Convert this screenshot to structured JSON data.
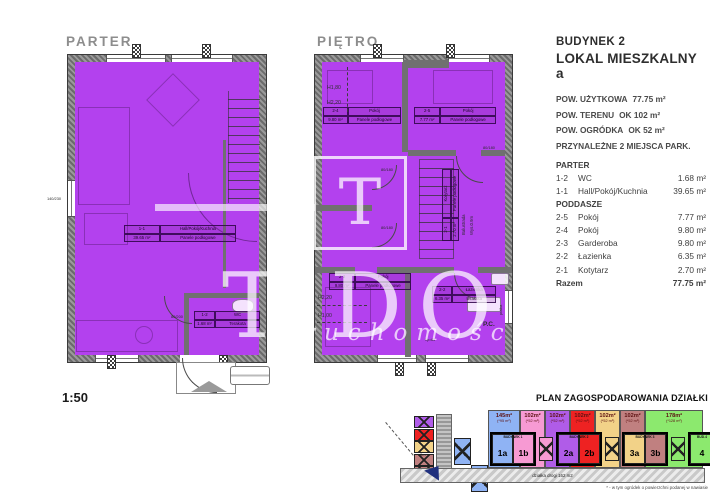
{
  "scale_label": "1:50",
  "colors": {
    "room_fill": "#b341ee",
    "wall": "#6e6e6e"
  },
  "icons": {
    "north_arrow": "north-arrow",
    "vent": "vent-marker",
    "watermark_logo": "letter-T-logo"
  },
  "watermark": {
    "logo_letter": "T",
    "word_t": "T",
    "word_dor": "DOR",
    "sub": "ruchomości"
  },
  "plans": {
    "parter": {
      "title": "PARTER",
      "hall": {
        "code": "1-1",
        "name": "Hall/Pokój/Kuchnia",
        "area": "39.65 m²",
        "floor": "Panele podłogowe"
      },
      "wc": {
        "code": "1-2",
        "name": "WC",
        "area": "1.68 m²",
        "floor": "Terakota"
      },
      "dims": {
        "left_window": "140/230",
        "wc_door": "80/200"
      }
    },
    "pietro": {
      "title": "PIĘTRO",
      "room24": {
        "code": "2-4",
        "name": "Pokój",
        "area": "9.80 m²",
        "floor": "Panele podłogowe"
      },
      "room25": {
        "code": "2-5",
        "name": "Pokój",
        "area": "7.77 m²",
        "floor": "Panele podłogowe"
      },
      "room23": {
        "code": "2-3",
        "name": "Pokój",
        "area": "9.80 m²",
        "floor": "Panele podłogowe"
      },
      "bath": {
        "code": "2-2",
        "name": "Łazienka",
        "area": "6.35 m²",
        "floor": "terakota"
      },
      "corridor": {
        "code": "2-1",
        "name": "Korytarz",
        "area": "2.70 m²",
        "floor": "Panele podłogowe"
      },
      "labels": {
        "balustrade": "Balustrada",
        "balustrade_h": "Wys.0.9m",
        "pc": "P.C.",
        "washer": "pralka",
        "hp": "hp=85",
        "h180": "H1,80",
        "h220": "H2,20",
        "h220b": "H2,20",
        "h100": "H1,00",
        "door1": "80/180",
        "door2": "80/180",
        "door3": "80/180"
      }
    }
  },
  "info": {
    "building": "BUDYNEK 2",
    "unit": "LOKAL MIESZKALNY a",
    "stats": [
      {
        "label": "POW. UŻYTKOWA",
        "value": "77.75 m²"
      },
      {
        "label": "POW. TERENU",
        "value": "OK 102 m²"
      },
      {
        "label": "POW. OGRÓDKA",
        "value": "OK 52 m²"
      },
      {
        "label": "PRZYNALEŻNE 2 MIEJSCA PARK.",
        "value": ""
      }
    ],
    "list": {
      "h1": "PARTER",
      "r1": {
        "code": "1-2",
        "name": "WC",
        "area": "1.68 m²"
      },
      "r2": {
        "code": "1-1",
        "name": "Hall/Pokój/Kuchnia",
        "area": "39.65 m²"
      },
      "h2": "PODDASZE",
      "r3": {
        "code": "2-5",
        "name": "Pokój",
        "area": "7.77 m²"
      },
      "r4": {
        "code": "2-4",
        "name": "Pokój",
        "area": "9.80 m²"
      },
      "r5": {
        "code": "2-3",
        "name": "Garderoba",
        "area": "9.80 m²"
      },
      "r6": {
        "code": "2-2",
        "name": "Łazienka",
        "area": "6.35 m²"
      },
      "r7": {
        "code": "2-1",
        "name": "Kotytarz",
        "area": "2.70 m²"
      },
      "total": {
        "label": "Razem",
        "area": "77.75 m²"
      }
    }
  },
  "site": {
    "title": "PLAN ZAGOSPODAROWANIA DZIAŁKI",
    "road_label": "działka drogi 162 m2",
    "footnote": "* - w tym ogródek o powierzchni podanej w nawiasie",
    "width_label": "6m",
    "parcels": [
      {
        "area": "145m²",
        "garden": "(*95 m²)",
        "color": "#8fb3f4"
      },
      {
        "area": "102m²",
        "garden": "(*52 m²)",
        "color": "#f79ad3"
      },
      {
        "area": "102m²",
        "garden": "(*52 m²)",
        "color": "#b05ce8"
      },
      {
        "area": "102m²",
        "garden": "(*52 m²)",
        "color": "#ee2222"
      },
      {
        "area": "102m²",
        "garden": "(*52 m²)",
        "color": "#f2d288"
      },
      {
        "area": "102m²",
        "garden": "(*52 m²)",
        "color": "#c08080"
      },
      {
        "area": "178m²",
        "garden": "(*128 m²)",
        "color": "#8ce96e"
      }
    ],
    "buildings": [
      {
        "name": "BUDYNEK 1",
        "u1": "1a",
        "u2": "1b",
        "c1": "#8fb3f4",
        "c2": "#f79ad3"
      },
      {
        "name": "BUDYNEK 2",
        "u1": "2a",
        "u2": "2b",
        "c1": "#b05ce8",
        "c2": "#ee2222"
      },
      {
        "name": "BUDYNEK 3",
        "u1": "3a",
        "u2": "3b",
        "c1": "#f2d288",
        "c2": "#c08080"
      },
      {
        "name": "BUD.4",
        "u1": "4",
        "c1": "#8ce96e"
      }
    ],
    "parking": {
      "col0": "#b05ce8",
      "col1": "#ee2222",
      "col2": "#f2d288",
      "col3": "#c08080",
      "col4": "#c08080",
      "pair": "#8fb3f4",
      "x1": "#f79ad3",
      "x2": "#f2d288",
      "x3": "#8ce96e"
    }
  }
}
